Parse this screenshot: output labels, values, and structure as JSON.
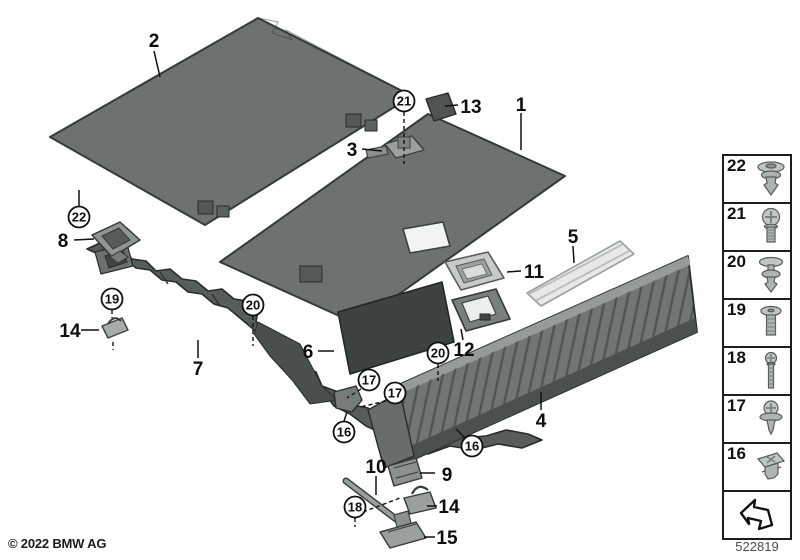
{
  "footer": {
    "copyright": "© 2022 BMW AG",
    "diagram_number": "522819"
  },
  "labels": {
    "n1": "1",
    "n2": "2",
    "n3": "3",
    "n4": "4",
    "n5": "5",
    "n6": "6",
    "n7": "7",
    "n8": "8",
    "n9": "9",
    "n10": "10",
    "n11": "11",
    "n12": "12",
    "n13": "13",
    "n14": "14",
    "n15": "15",
    "n16": "16",
    "n17": "17",
    "n18": "18",
    "n19": "19",
    "n20": "20",
    "n21": "21",
    "n22": "22"
  },
  "sidebar": {
    "items": [
      {
        "label": "22",
        "icon": "push-rivet-icon"
      },
      {
        "label": "21",
        "icon": "pan-head-screw-icon"
      },
      {
        "label": "20",
        "icon": "expanding-rivet-icon"
      },
      {
        "label": "19",
        "icon": "flat-head-screw-icon"
      },
      {
        "label": "18",
        "icon": "long-screw-icon"
      },
      {
        "label": "17",
        "icon": "washer-screw-icon"
      },
      {
        "label": "16",
        "icon": "clip-nut-icon"
      }
    ],
    "arrow_icon": "reference-arrow-icon"
  },
  "colors": {
    "panel": "#6c7271",
    "panel_dark": "#3d4343",
    "carrier": "#565d5c",
    "corrugated": "#6f7675",
    "strip_light": "#e7e9e8",
    "hardware": "#c0c6c5",
    "outline": "#141818"
  }
}
